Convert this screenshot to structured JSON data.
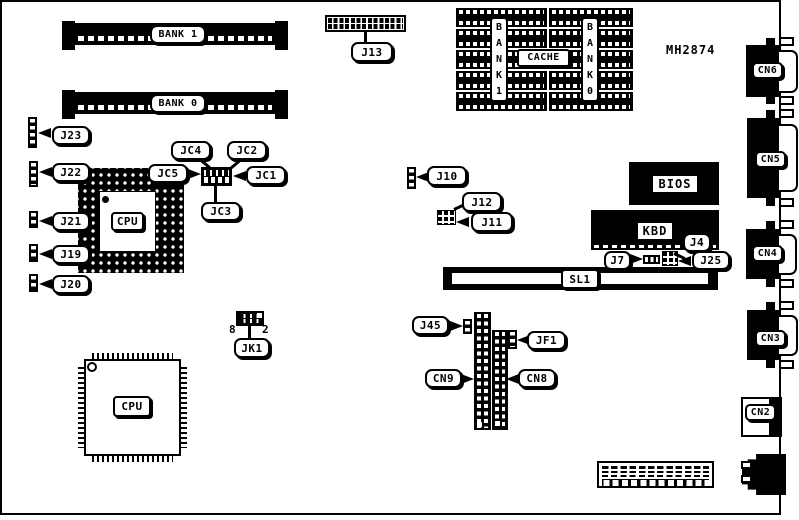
{
  "part_number": "MH2874",
  "memory_slots": {
    "bank1": "BANK 1",
    "bank0": "BANK 0"
  },
  "cache": {
    "label": "CACHE",
    "bank1_col": "B\nA\nN\nK\n1",
    "bank0_col": "B\nA\nN\nK\n0"
  },
  "chips": {
    "bios": "BIOS",
    "kbd": "KBD",
    "cpu_socket": "CPU",
    "cpu_qfp": "CPU"
  },
  "slots": {
    "sl1": "SL1"
  },
  "connectors": {
    "cn2": "CN2",
    "cn3": "CN3",
    "cn4": "CN4",
    "cn5": "CN5",
    "cn6": "CN6",
    "cn8": "CN8",
    "cn9": "CN9"
  },
  "jumpers": {
    "j4": "J4",
    "j7": "J7",
    "j10": "J10",
    "j11": "J11",
    "j12": "J12",
    "j13": "J13",
    "j19": "J19",
    "j20": "J20",
    "j21": "J21",
    "j22": "J22",
    "j23": "J23",
    "j25": "J25",
    "j45": "J45",
    "jc1": "JC1",
    "jc2": "JC2",
    "jc3": "JC3",
    "jc4": "JC4",
    "jc5": "JC5",
    "jf1": "JF1",
    "jk1": "JK1"
  },
  "pins": {
    "jk1_pin8": "8",
    "jk1_pin2": "2"
  }
}
